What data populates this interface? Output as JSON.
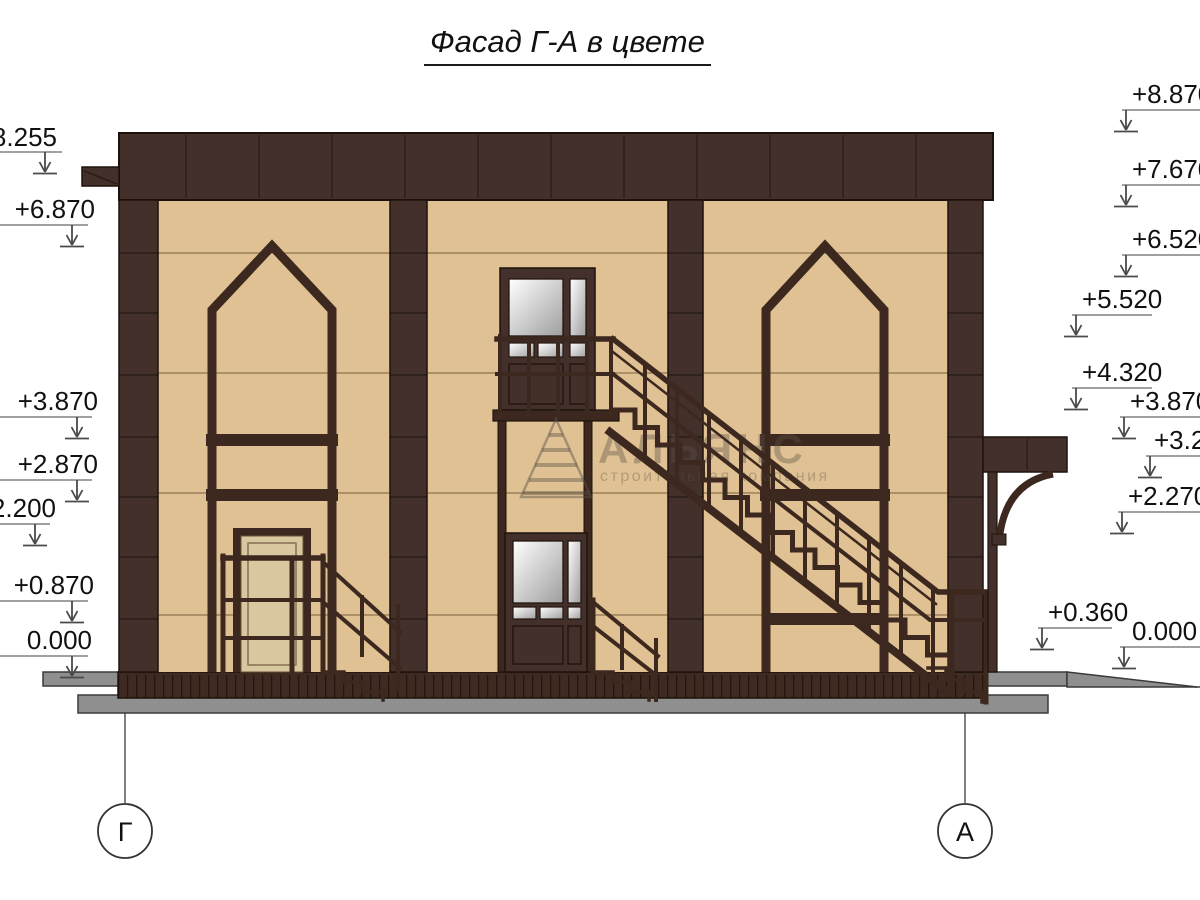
{
  "title": "Фасад Г-А в цвете",
  "watermark": {
    "name": "АЛЬЯНС",
    "tagline": "строительная компания"
  },
  "axes": {
    "left": "Г",
    "right": "А"
  },
  "elevation_marks": {
    "left": [
      "+8.255",
      "+6.870",
      "+3.870",
      "+2.870",
      "+2.200",
      "+0.870",
      "0.000"
    ],
    "right": [
      "+8.870",
      "+7.670",
      "+6.520",
      "+5.520",
      "+4.320",
      "+3.870",
      "+3.270",
      "+2.270",
      "+0.360",
      "0.000"
    ]
  },
  "colors": {
    "facade_wall": "#dfc193",
    "trim_dark_brown": "#44302a",
    "frame_brown": "#3c281e",
    "plinth": "#3e2a20",
    "sidewalk_gray": "#8f8f8f",
    "glass_light": "#ffffff",
    "glass_shade": "#9e9e9e"
  }
}
